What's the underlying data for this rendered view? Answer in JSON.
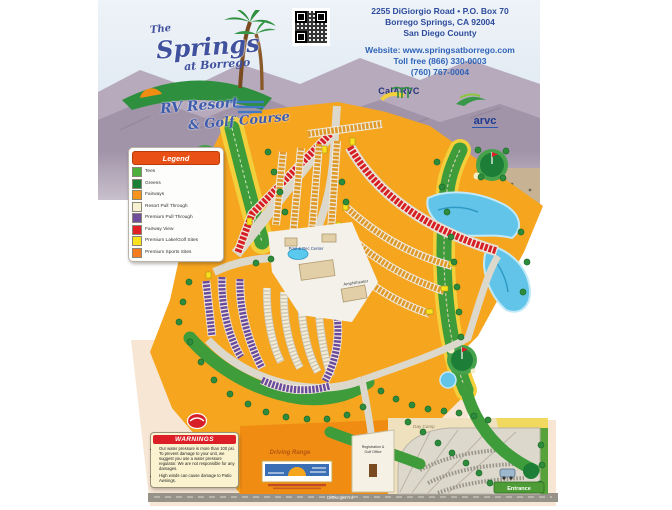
{
  "header": {
    "address_line1": "2255 DiGiorgio Road • P.O. Box 70",
    "address_line2": "Borrego Springs, CA 92004",
    "address_line3": "San Diego County",
    "website_line": "Website: www.springsatborrego.com",
    "phone_line1": "Toll free (866) 330-0003",
    "phone_line2": "(760) 767-0004"
  },
  "brand": {
    "script_the": "The",
    "script_name": "Springs",
    "script_at": "at Borrego",
    "tagline1": "RV Resort",
    "tagline2": "& Golf Course"
  },
  "associations": {
    "left_name": "CalARVC",
    "right_name": "arvc"
  },
  "legend": {
    "title": "Legend",
    "items": [
      {
        "label": "Tees",
        "color": "#4caf3e"
      },
      {
        "label": "Greens",
        "color": "#1c7e37"
      },
      {
        "label": "Fairways",
        "color": "#f7941d"
      },
      {
        "label": "Resort Pull Through",
        "color": "#f6f0d0"
      },
      {
        "label": "Premium Pull Through",
        "color": "#6f4f9b"
      },
      {
        "label": "Fairway View",
        "color": "#e01f26"
      },
      {
        "label": "Premium Lake/Golf Sites",
        "color": "#f9e11e"
      },
      {
        "label": "Premium Sports Sites",
        "color": "#f47b20"
      }
    ]
  },
  "warnings": {
    "title": "WARNINGS",
    "items": [
      "Our water pressure is more than 100 psi. To prevent damage to your unit, we suggest you use a water pressure regulator. We are not responsible for any damages.",
      "High winds can cause damage to Patio Awnings."
    ]
  },
  "map_labels": {
    "pool": "Pool & Rec Center",
    "amphitheater": "Amphitheater",
    "driving_range": "Driving Range",
    "day_camp": "Day Camp",
    "registration_line1": "Registration &",
    "registration_line2": "Golf Office",
    "road": "DiGiorgio Rd",
    "entrance": "Entrance"
  },
  "colors": {
    "map_orange": "#f6a51f",
    "warning_red": "#dc1f26",
    "legend_header_orange": "#e85016",
    "lake_blue": "#62c4e8",
    "peach_paper": "#f7e6d4"
  }
}
